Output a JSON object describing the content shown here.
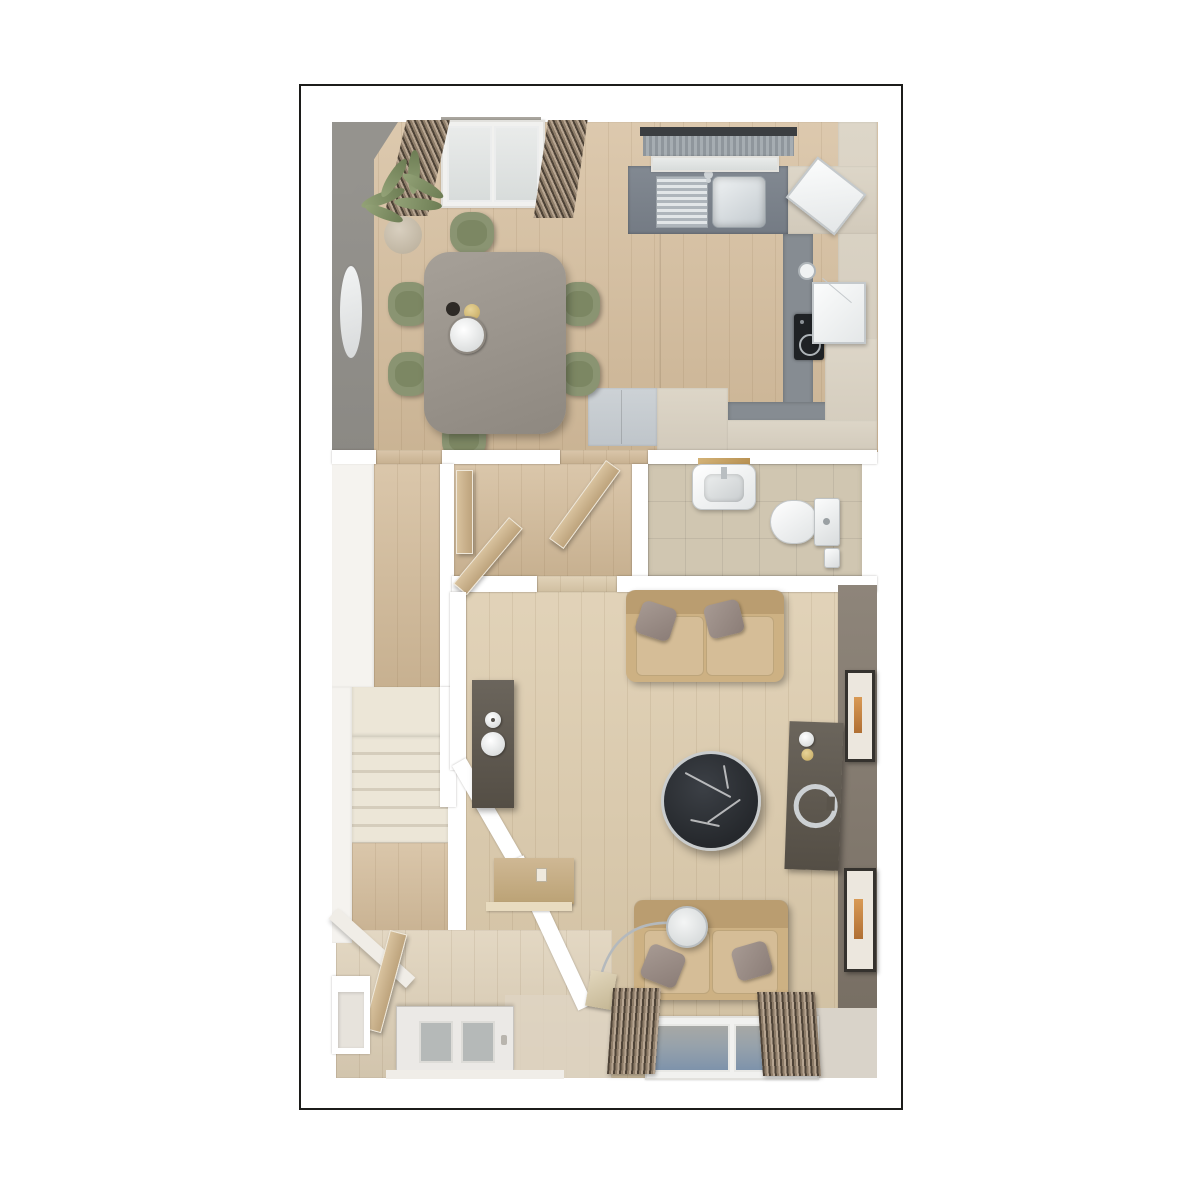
{
  "image_type": "3d-isometric-floor-plan-render",
  "title_visible_text": "",
  "palette": {
    "frame": "#1c1c1a",
    "wood-dining": "#d5bd9c",
    "wood-living": "#dbc9a9",
    "wood-hall": "#d2ba98",
    "wood-entry": "#ddcfb6",
    "tile-wc": "#d0c6b1",
    "tile-kitchen": "#868c92",
    "cabinet-cream": "#d9d2c3",
    "hob-black": "#1f2225",
    "chair-green": "#8a9472",
    "sofa-tan": "#cdb183",
    "stair-cream": "#ece6d7",
    "wall-gray": "#908e89",
    "wall-taupe": "#8b8177",
    "curtain-brown": "#7a6a58",
    "glass-blue": "#8fa0af",
    "marble-black": "#2b2e32",
    "media-dark": "#5e574e",
    "door-wood": "#c9ae86",
    "art-orange": "#c77b3a",
    "plant-green": "#7e8e62"
  },
  "scene": {
    "rooms": [
      {
        "name": "kitchen-dining",
        "floor": "light-oak-planks",
        "items": [
          "dining-table",
          "6-green-chairs",
          "potted-plant",
          "oval-wall-mirror",
          "french-door-with-curtains",
          "window-with-roller-blind",
          "sink-with-drainer",
          "corner-chopping-board",
          "induction-hob",
          "kettle",
          "white-appliance",
          "cream-cabinets",
          "gray-worktop",
          "fridge-unit"
        ]
      },
      {
        "name": "wc",
        "floor": "beige-tiles",
        "items": [
          "wash-basin",
          "wood-shelf",
          "toilet",
          "paper-holder"
        ]
      },
      {
        "name": "hallway",
        "floor": "oak-planks",
        "items": [
          "staircase",
          "open-door-x3",
          "console-unit-with-bowls",
          "wall-desk",
          "white-ledge",
          "front-door-with-glazing"
        ]
      },
      {
        "name": "living-room",
        "floor": "light-oak-planks",
        "items": [
          "two-seat-sofa",
          "loveseat",
          "round-black-marble-coffee-table",
          "dark-media-console",
          "arc-floor-lamp",
          "framed-art-x2",
          "window-with-curtains"
        ]
      }
    ],
    "counts": {
      "dining_chairs": 6,
      "sofas": 2,
      "framed_pictures": 2,
      "stair_treads": 6
    }
  }
}
